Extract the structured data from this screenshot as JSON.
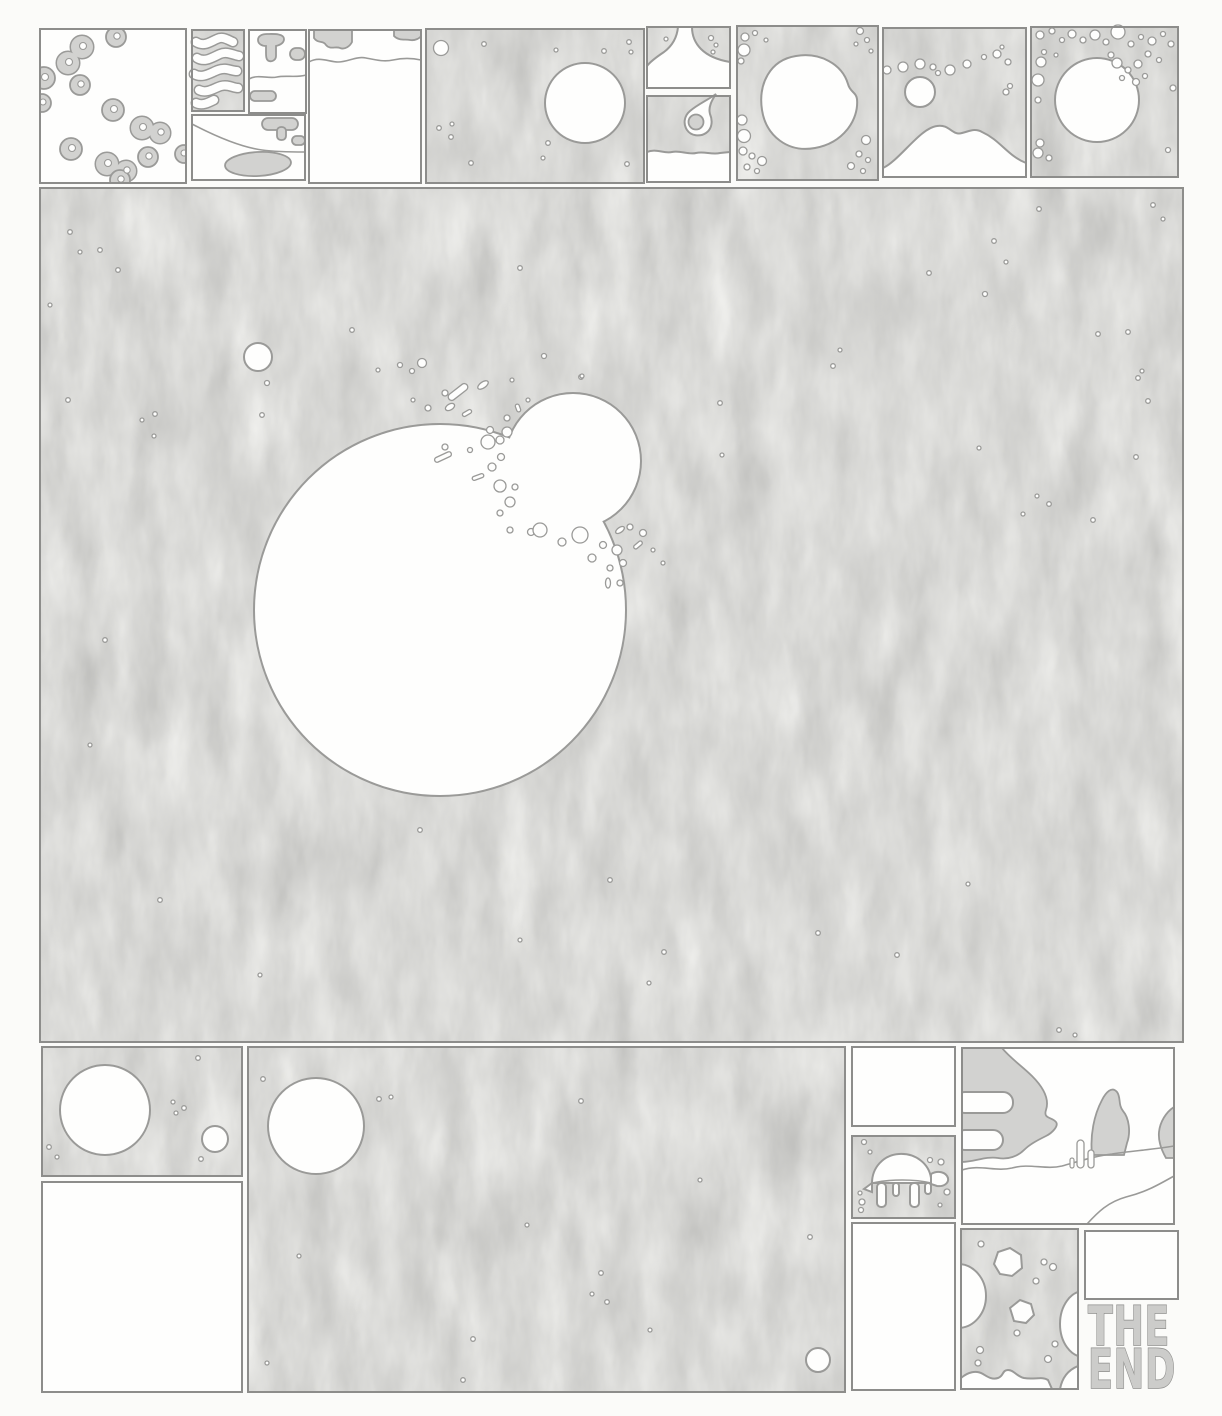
{
  "end_panel": {
    "line1": "THE",
    "line2": "END"
  },
  "colors": {
    "paper": "#fbfbf9",
    "panel_gray": "#d8d8d6",
    "line": "#8d8d8b",
    "line2": "#9a9a98",
    "white": "#fefefd",
    "shape": "#d2d2d0",
    "letter_fill": "#ccccca"
  },
  "panels": [
    "panel-cells",
    "panel-worm-strands",
    "panel-cloud-blobs-top",
    "panel-cloud-blobs-bottom",
    "panel-waterline",
    "panel-space-planet",
    "panel-valley",
    "panel-comet",
    "panel-blob-planet",
    "panel-mountains",
    "panel-bubble-planet",
    "panel-collision-main",
    "panel-moon-pair",
    "panel-blank-bottom-left",
    "panel-space-bottom",
    "panel-blank-top-mid",
    "panel-turtle",
    "panel-blank-mid",
    "panel-landscape",
    "panel-porous-rock",
    "panel-blank-end",
    "the-end-lettering"
  ]
}
